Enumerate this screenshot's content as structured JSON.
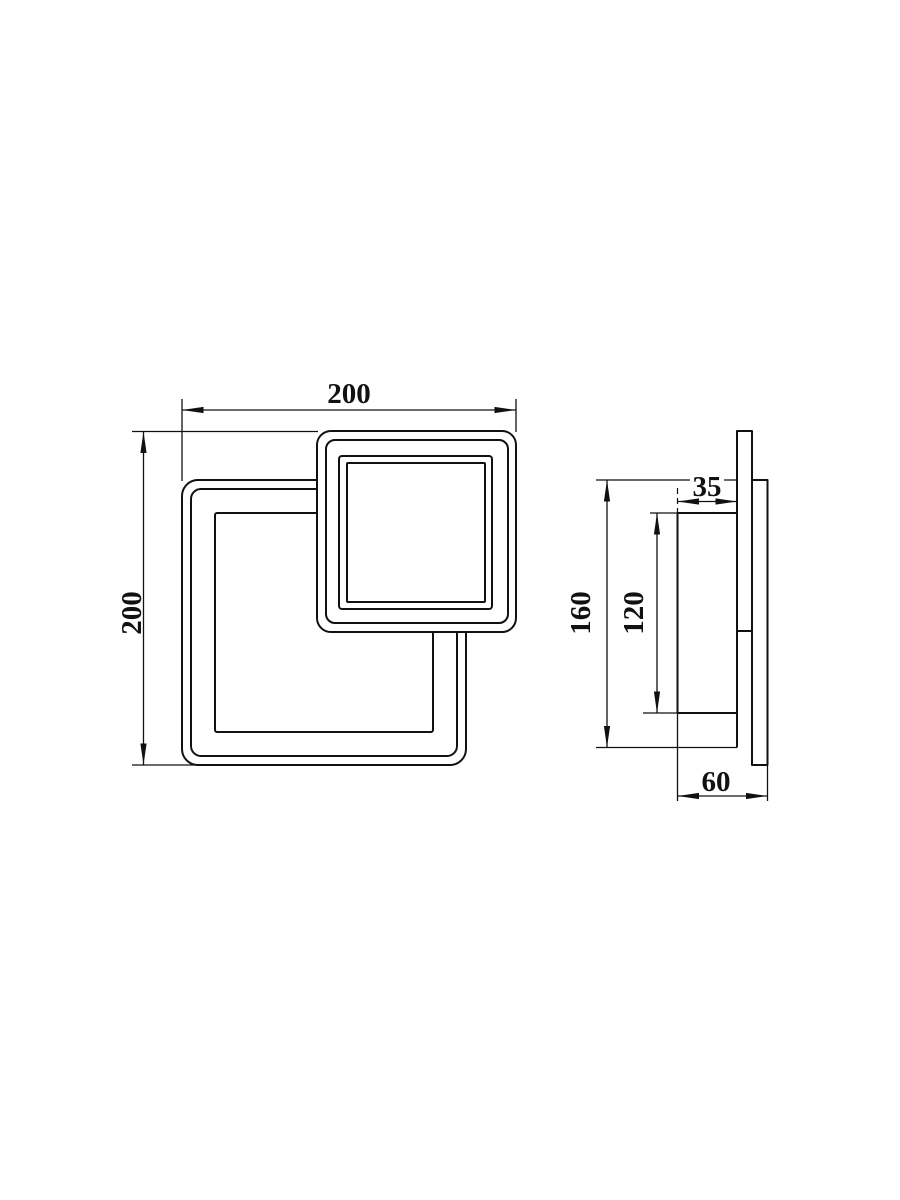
{
  "drawing": {
    "type": "technical-dimension-drawing",
    "subject": "square LED wall lamp, front and side orthographic views",
    "colors": {
      "line": "#111111",
      "background": "#ffffff"
    },
    "views": {
      "front": {
        "width": "200",
        "height": "200"
      },
      "side": {
        "panel_depth": "35",
        "mount_height": "160",
        "panel_height": "120",
        "total_depth": "60"
      }
    }
  }
}
